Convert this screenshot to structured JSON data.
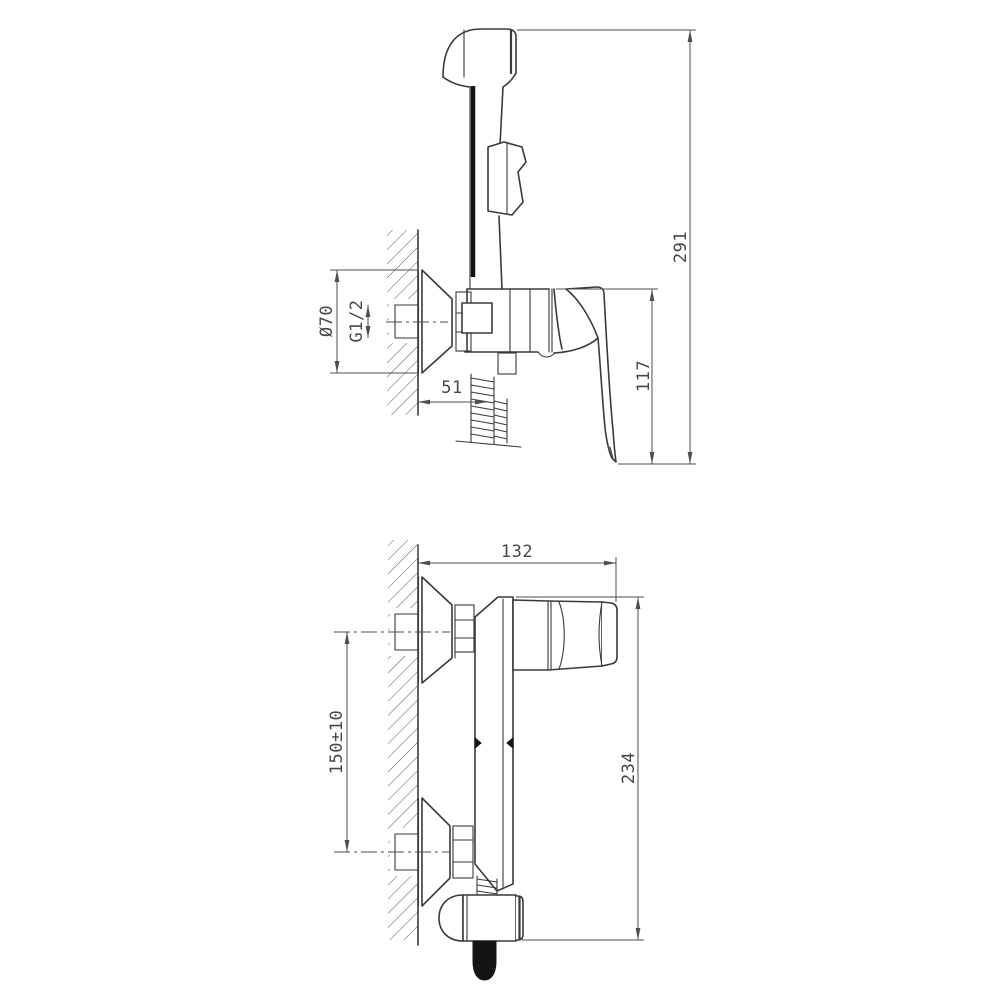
{
  "colors": {
    "background": "#ffffff",
    "line": "#3a3a3a",
    "dimension_line": "#4f4f4f",
    "text": "#474747",
    "hatch": "#5a5a5a",
    "solid_fill": "#141414"
  },
  "side_view": {
    "labels": {
      "total_height": "291",
      "lever_height": "117",
      "flange_diameter": "Ø70",
      "thread_size": "G1/2",
      "wall_offset": "51"
    }
  },
  "front_view": {
    "labels": {
      "overall_width": "132",
      "overall_height": "234",
      "inlet_spacing": "150±10"
    }
  }
}
